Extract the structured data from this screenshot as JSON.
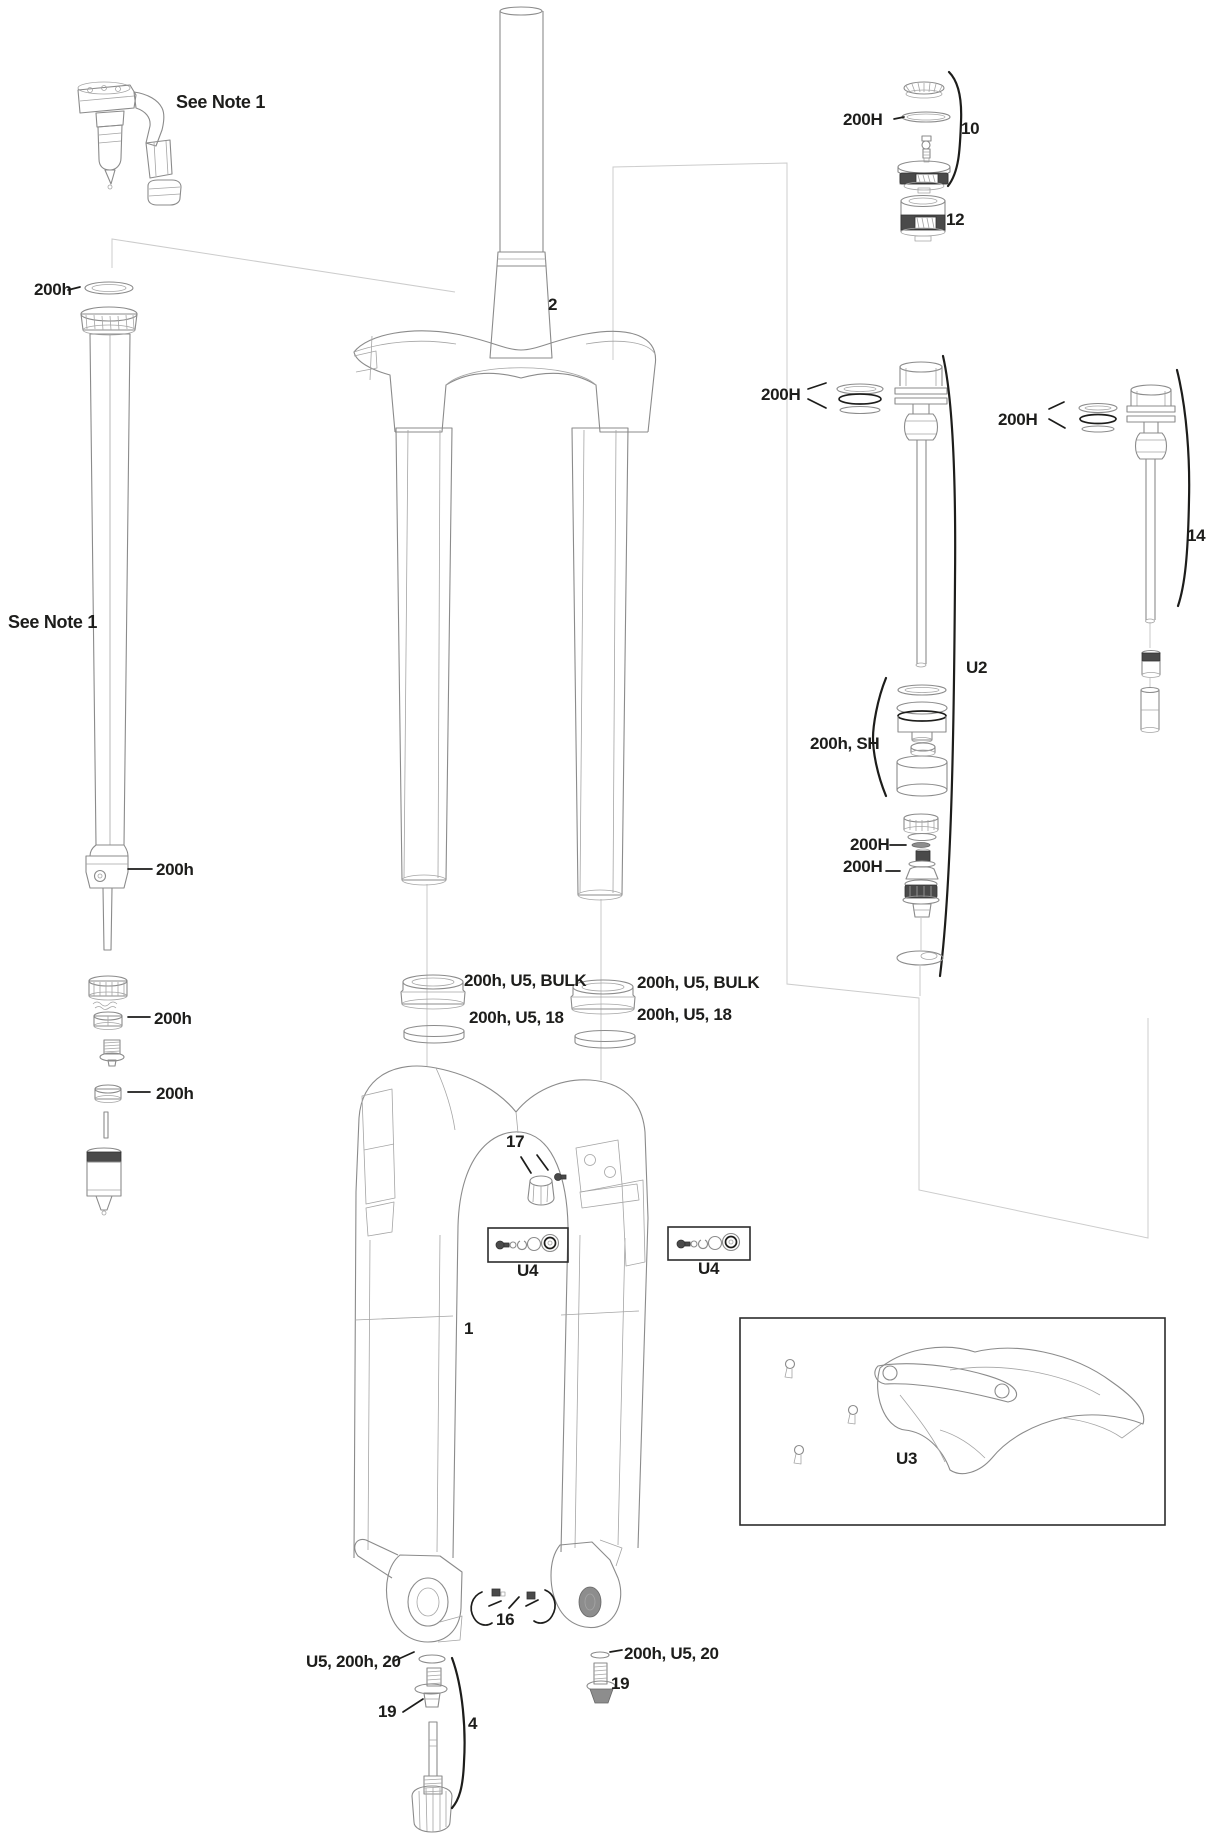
{
  "meta": {
    "description": "Exploded parts diagram of a bicycle suspension fork",
    "background_color": "#ffffff",
    "line_color": "#8b8b8b",
    "label_color": "#1d1d1b",
    "dark_fill_color": "#4a4a4a"
  },
  "labels": {
    "see_note_top": "See Note 1",
    "damper_top_seal": "200h",
    "see_note_left": "See Note 1",
    "damper_collar": "200h",
    "damper_ring_upper": "200h",
    "damper_ring_lower": "200h",
    "steerer": "2",
    "dust_seal_left": "200h, U5, BULK",
    "foam_ring_left": "200h, U5, 18",
    "dust_seal_right": "200h, U5, BULK",
    "foam_ring_right": "200h, U5, 18",
    "air_cap_oring": "200H",
    "air_cap_group": "10",
    "air_piston": "12",
    "shaft_rings_mid": "200H",
    "shaft_rings_right": "200H",
    "damper_shaft_right": "14",
    "damper_assembly_mid": "U2",
    "seal_head_group": "200h, SH",
    "rebound_shim": "200H",
    "rebound_spacer": "200H",
    "compression_knob": "17",
    "hardware_kit_left": "U4",
    "hardware_kit_right": "U4",
    "lower_legs": "1",
    "fender_kit": "U3",
    "axle_clips": "16",
    "shaft_bolt_left_group": "U5, 200h, 20",
    "shaft_bolt_left": "19",
    "rebound_knob_group": "4",
    "shaft_bolt_right_group": "200h, U5, 20",
    "shaft_bolt_right": "19"
  }
}
